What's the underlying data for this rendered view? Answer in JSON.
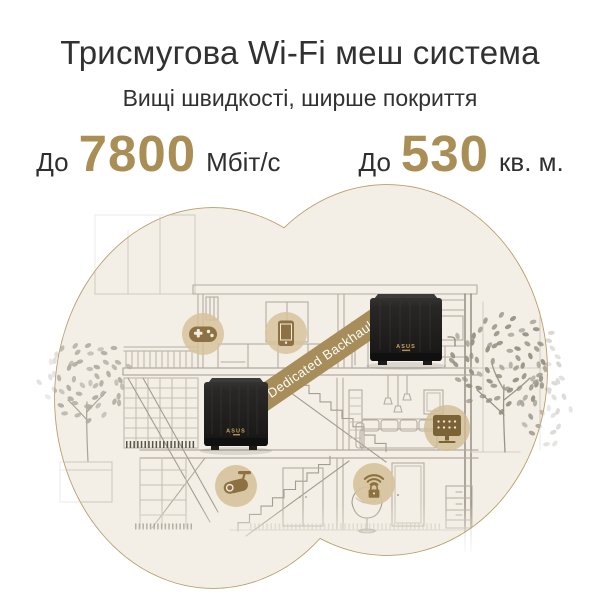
{
  "header": {
    "title": "Трисмугова Wi-Fi меш система",
    "subtitle": "Вищі швидкості, ширше покриття",
    "stats": [
      {
        "prefix": "До",
        "value": "7800",
        "unit": "Мбіт/с"
      },
      {
        "prefix": "До",
        "value": "530",
        "unit": "кв. м."
      }
    ]
  },
  "illustration": {
    "backhaul_label": "Dedicated Backhaul",
    "router_brand": "ASUS",
    "router_count": 2,
    "device_icons": [
      "gamepad",
      "smartphone",
      "surveillance-camera",
      "secure-wifi",
      "smart-home-panel"
    ],
    "colors": {
      "accent_gold": "#a98e55",
      "ribbon_gold": "#a68d59",
      "blob_fill": "#f4efe6",
      "blob_border": "#b59c68",
      "icon_circle": "#d6c29b",
      "icon_glyph": "#8d7142",
      "router_body": "#1d1d1d",
      "logo_gold": "#c8a45e",
      "line_art": "#b3aba0",
      "heading_text": "#313131"
    }
  }
}
